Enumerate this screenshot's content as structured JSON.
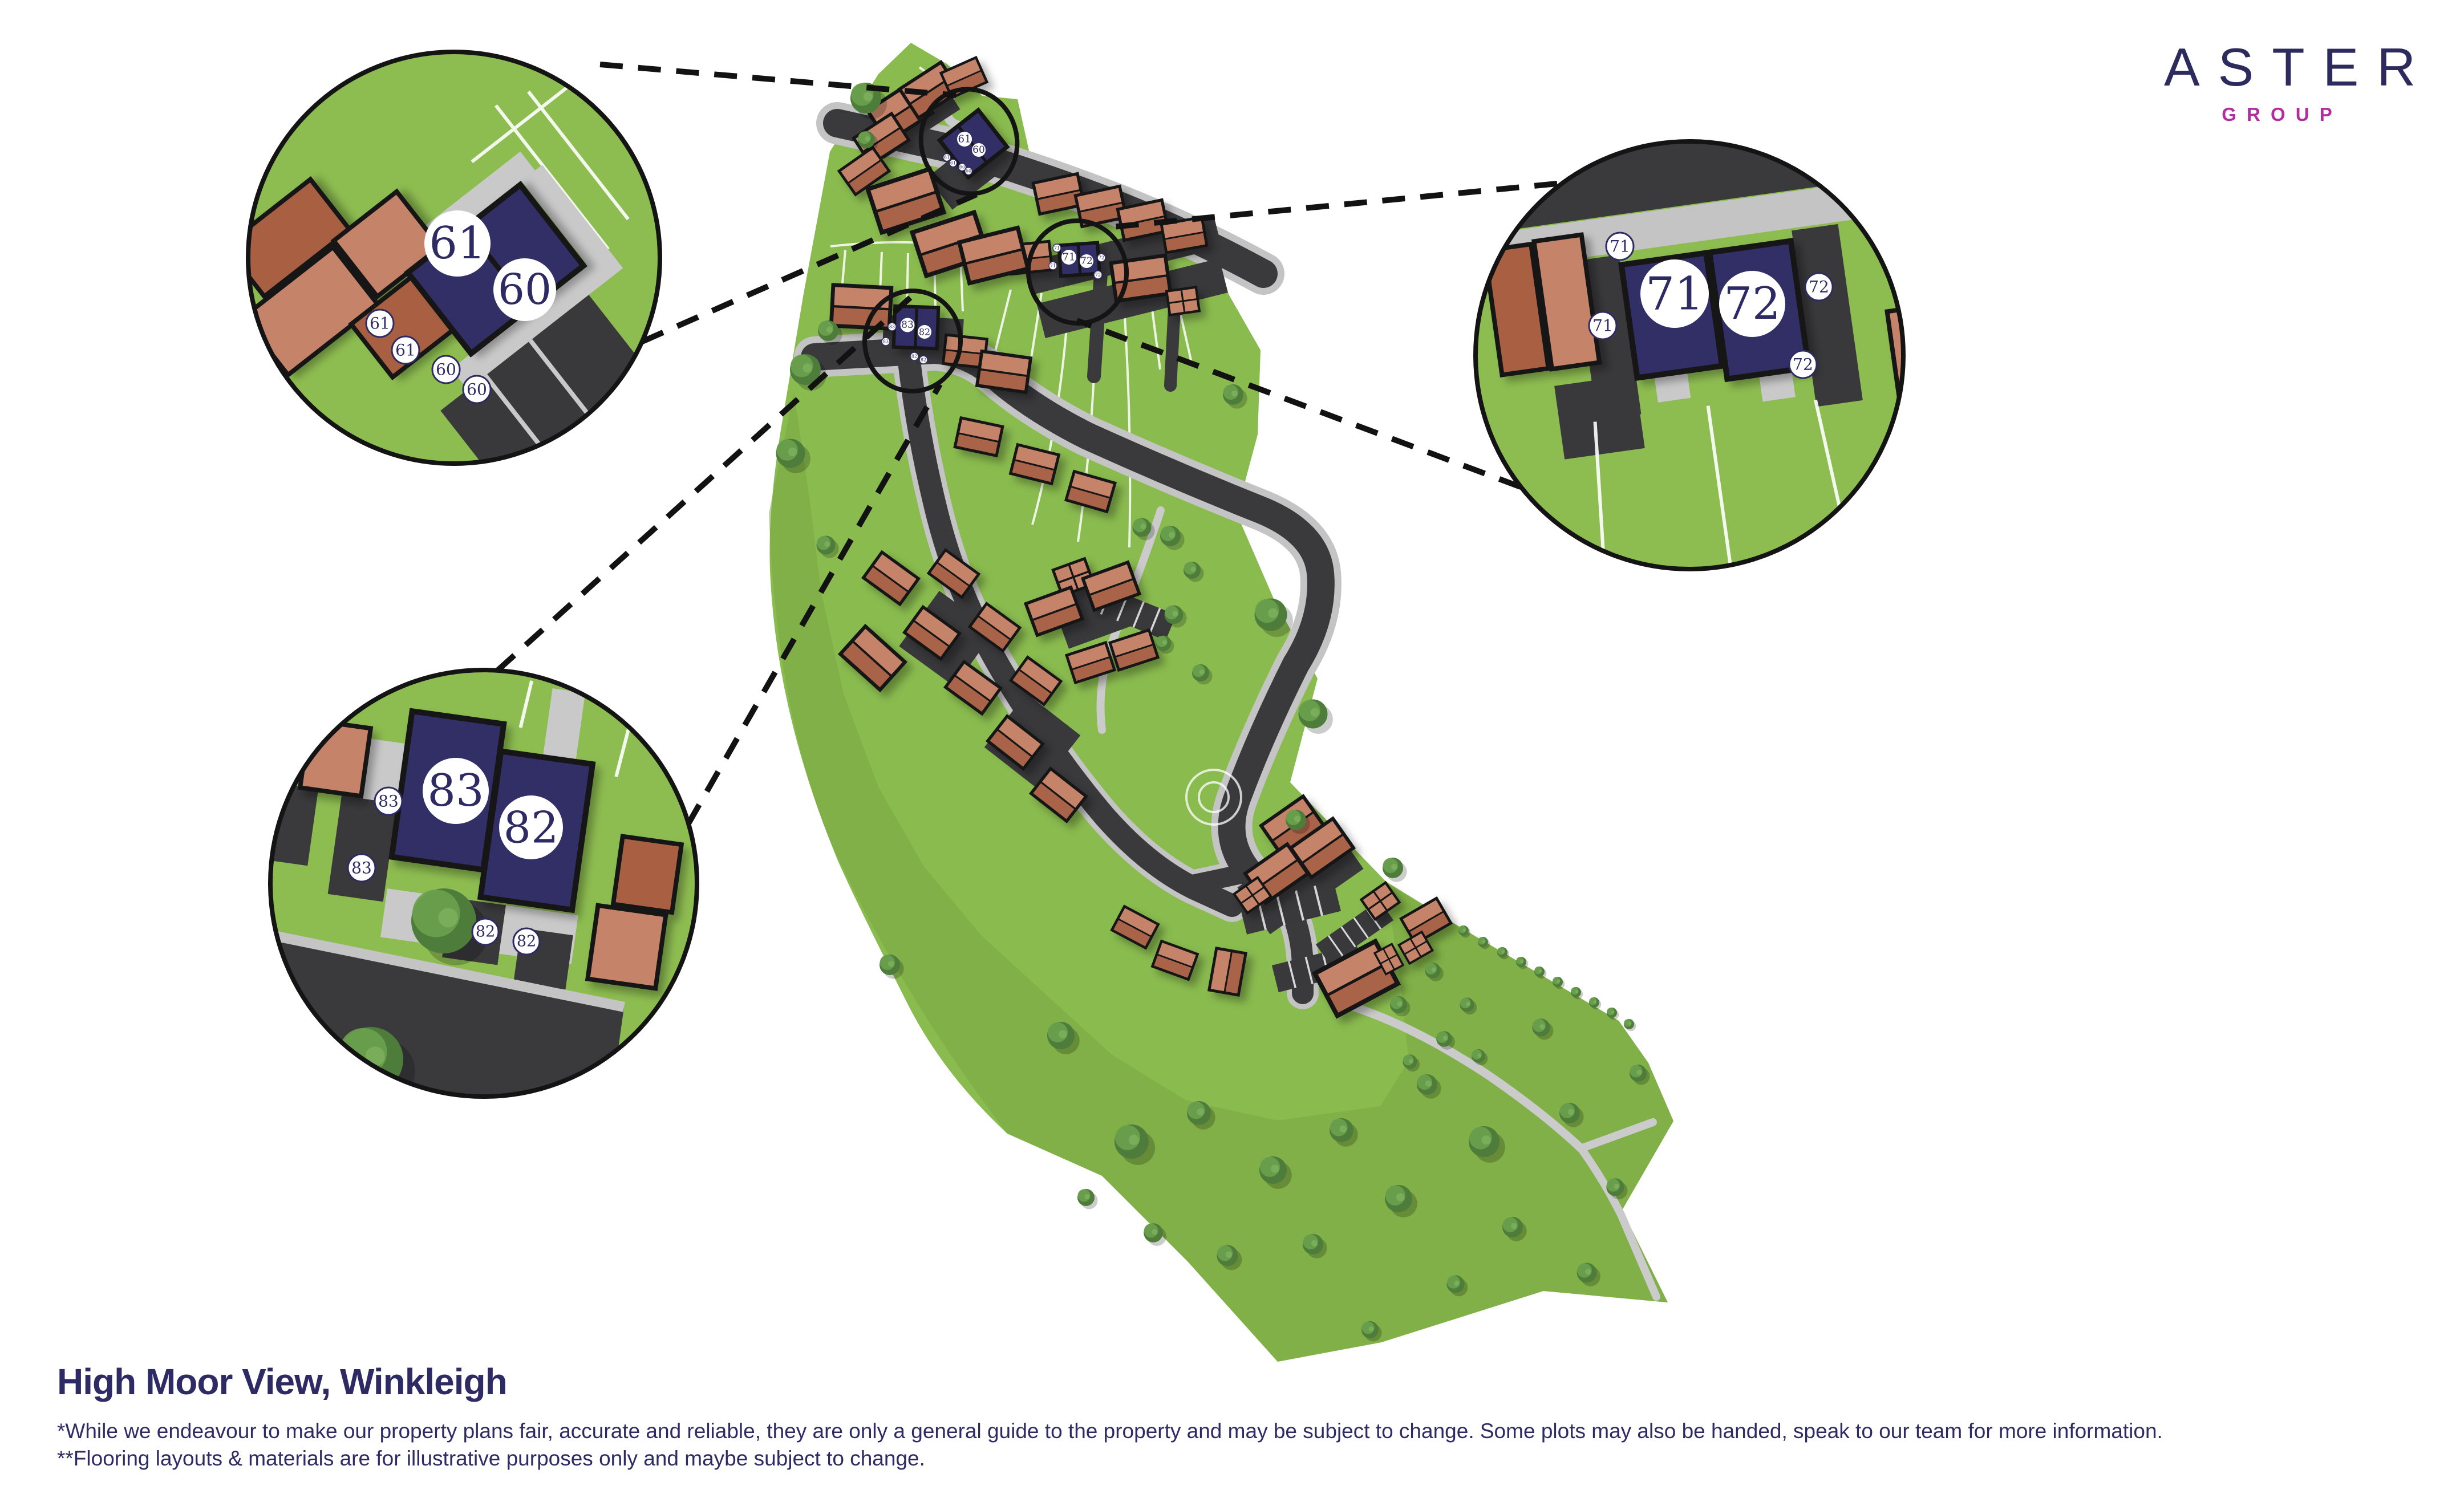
{
  "logo": {
    "brand": "ASTER",
    "sub": "GROUP"
  },
  "footer": {
    "title": "High Moor View, Winkleigh",
    "disclaimer_1": "*While we endeavour to make our property plans fair, accurate and reliable, they are only a general guide to the property and may be subject to change. Some plots may also be handed, speak to our team for more information.",
    "disclaimer_2": "**Flooring layouts & materials are for illustrative purposes only and maybe subject to change."
  },
  "callouts": {
    "c1": {
      "big": [
        "61",
        "60"
      ],
      "small": [
        "61",
        "61",
        "60",
        "60"
      ]
    },
    "c2": {
      "big": [
        "71",
        "72"
      ],
      "small": [
        "71",
        "71",
        "72",
        "72"
      ]
    },
    "c3": {
      "big": [
        "83",
        "82"
      ],
      "small": [
        "83",
        "83",
        "82",
        "82"
      ]
    }
  },
  "map": {
    "m1": {
      "big": [
        "61",
        "60"
      ],
      "small": [
        "61",
        "61",
        "60",
        "60"
      ]
    },
    "m2": {
      "big": [
        "71",
        "72"
      ],
      "small": [
        "71",
        "71",
        "72",
        "72"
      ]
    },
    "m3": {
      "big": [
        "83",
        "82"
      ],
      "small": [
        "83",
        "83",
        "82",
        "82"
      ]
    }
  },
  "colors": {
    "ink": "#2E2A63",
    "logo_navy": "#2D2A5E",
    "logo_magenta": "#B12DA2",
    "plot_navy": "#312E66",
    "grass": "#8ABB4F",
    "field": "#7FAE45",
    "road": "#3A3A3C",
    "pavement": "#C4C4C4",
    "brick_light": "#C5836A",
    "brick_dark": "#A85E43",
    "tree": "#4E7C3B"
  }
}
